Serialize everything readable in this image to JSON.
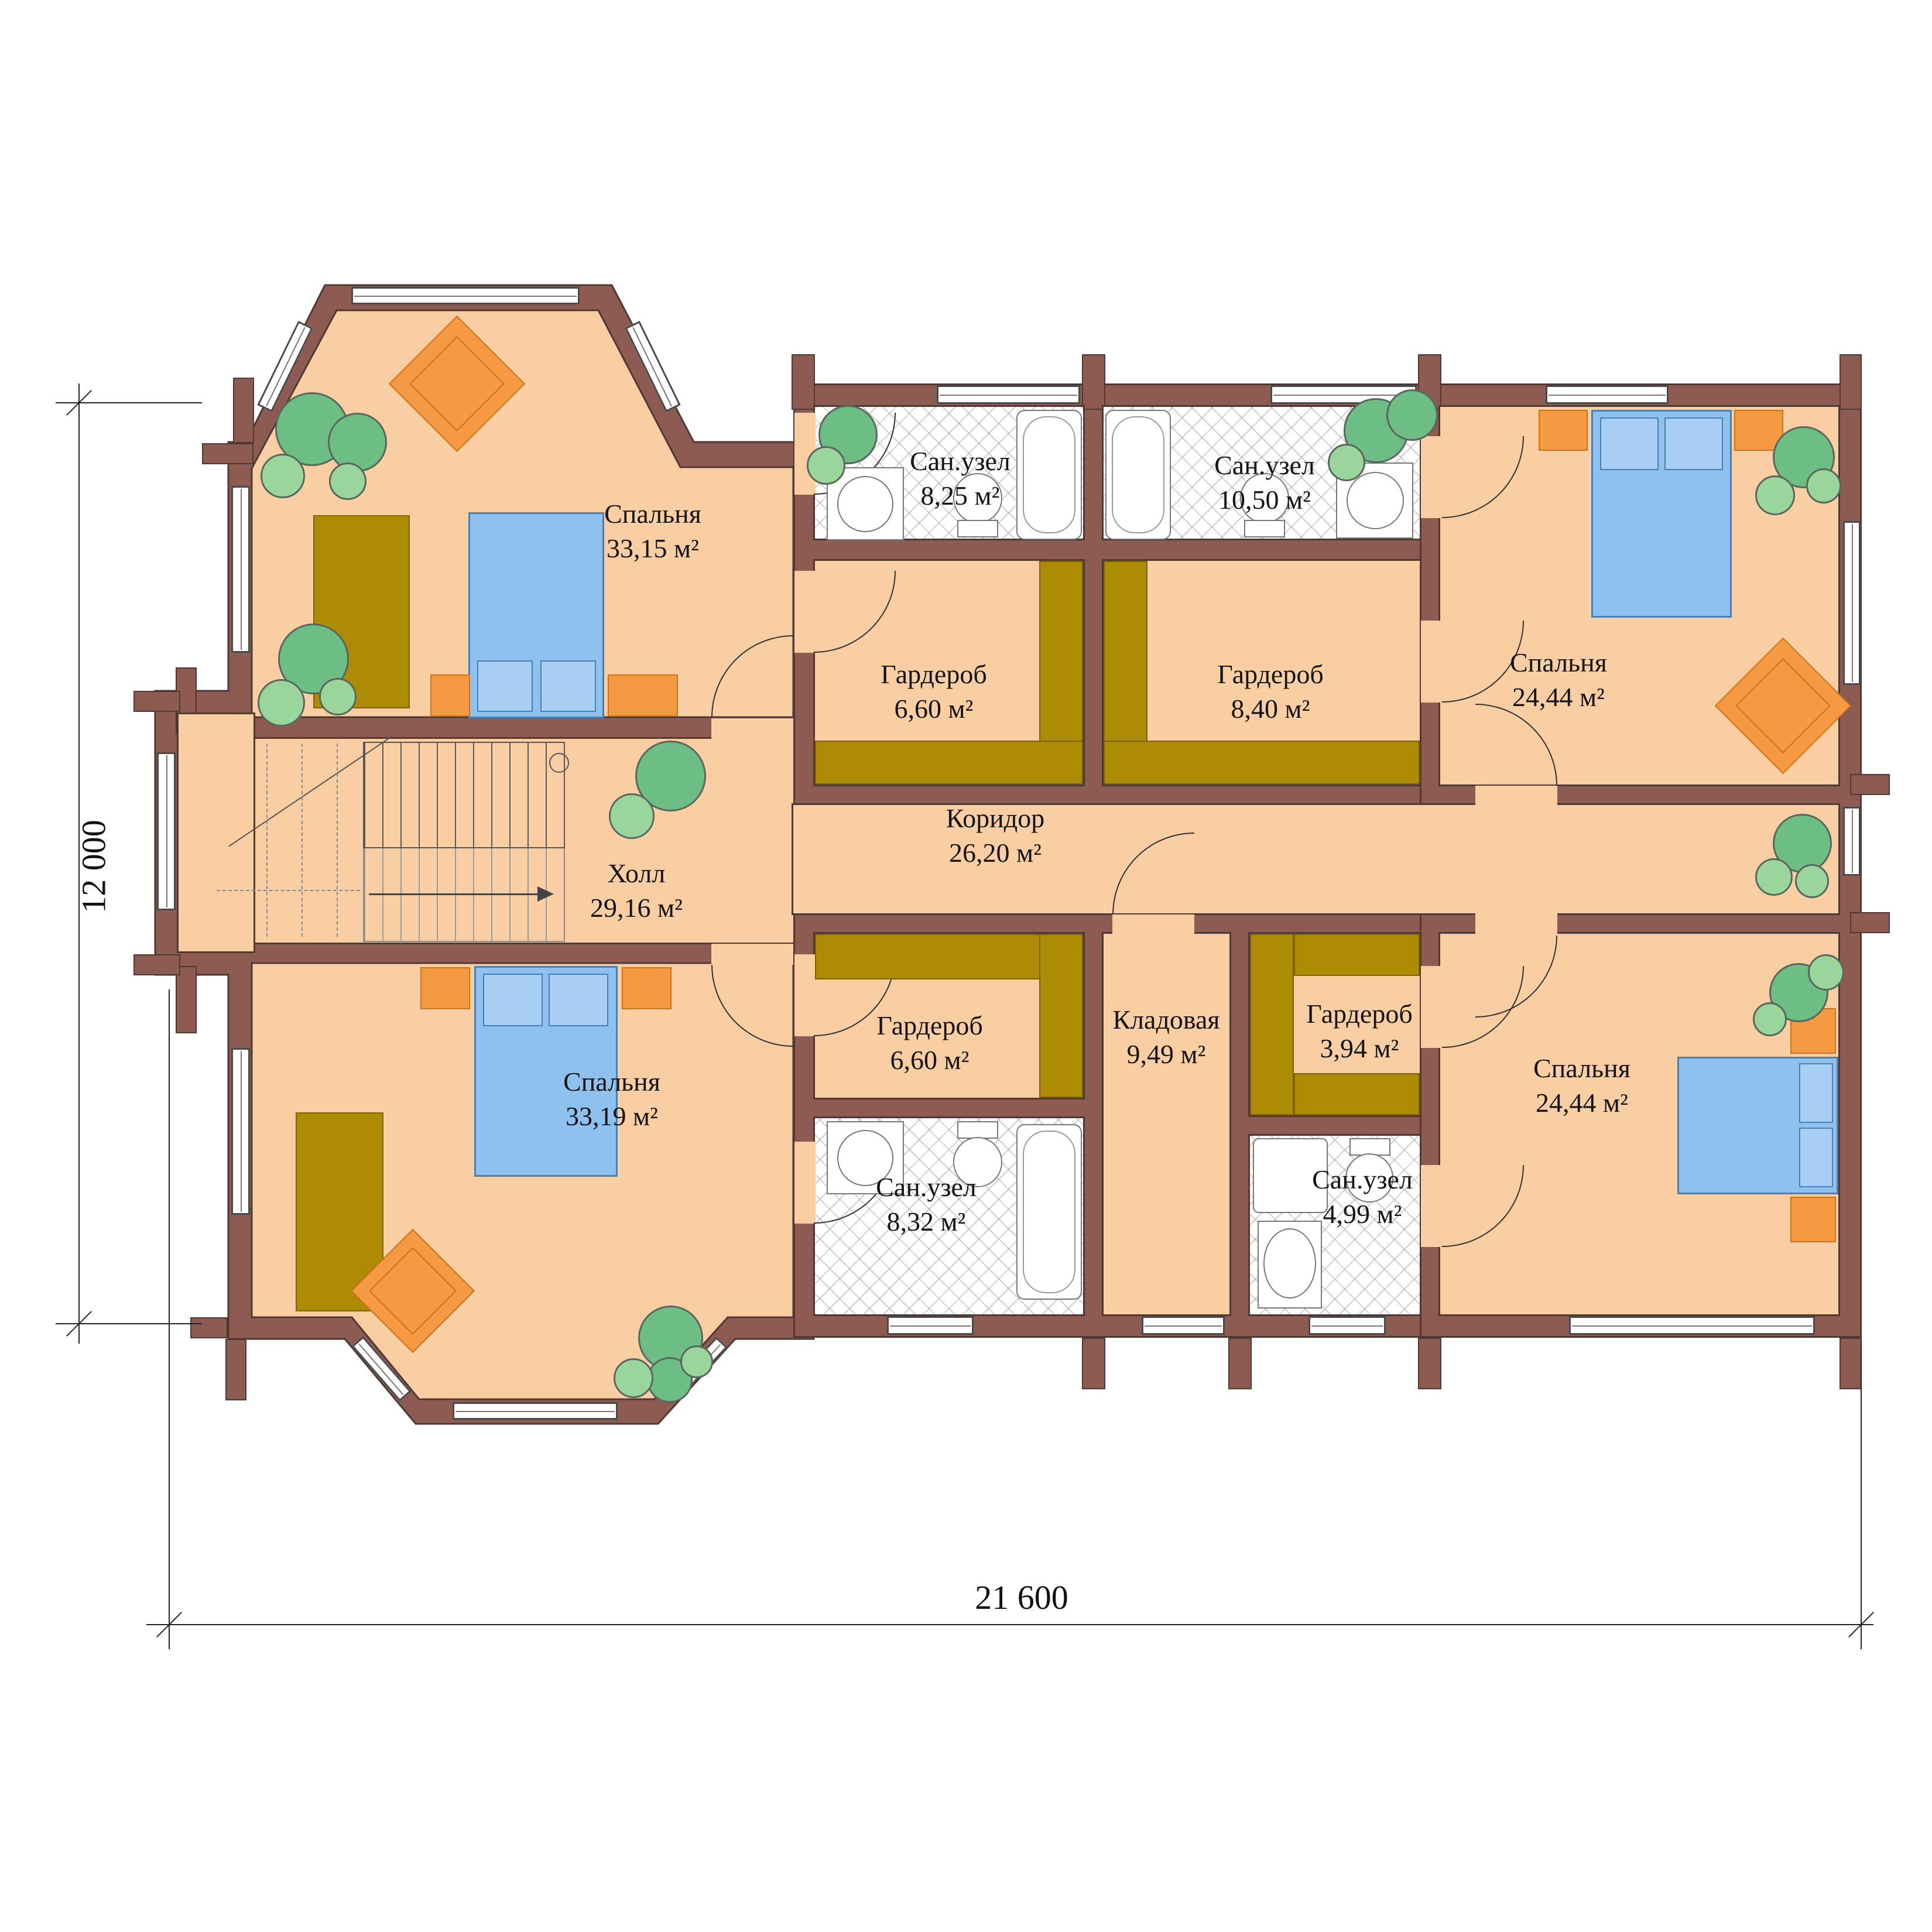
{
  "rooms": {
    "bedroom_top_left": {
      "name": "Спальня",
      "area": "33,15 м²"
    },
    "bath_top_left": {
      "name": "Сан.узел",
      "area": "8,25 м²"
    },
    "bath_top_right": {
      "name": "Сан.узел",
      "area": "10,50 м²"
    },
    "bedroom_top_right": {
      "name": "Спальня",
      "area": "24,44 м²"
    },
    "wardrobe_top_left": {
      "name": "Гардероб",
      "area": "6,60 м²"
    },
    "wardrobe_top_right": {
      "name": "Гардероб",
      "area": "8,40 м²"
    },
    "hall": {
      "name": "Холл",
      "area": "29,16 м²"
    },
    "corridor": {
      "name": "Коридор",
      "area": "26,20 м²"
    },
    "wardrobe_bottom_left": {
      "name": "Гардероб",
      "area": "6,60 м²"
    },
    "storage": {
      "name": "Кладовая",
      "area": "9,49 м²"
    },
    "wardrobe_bottom_right": {
      "name": "Гардероб",
      "area": "3,94 м²"
    },
    "bedroom_bottom_right": {
      "name": "Спальня",
      "area": "24,44 м²"
    },
    "bedroom_bottom_left": {
      "name": "Спальня",
      "area": "33,19 м²"
    },
    "bath_bottom_left": {
      "name": "Сан.узел",
      "area": "8,32 м²"
    },
    "bath_bottom_right": {
      "name": "Сан.узел",
      "area": "4,99 м²"
    }
  },
  "dimensions": {
    "overall_width": "21 600",
    "overall_height": "12 000"
  },
  "colors": {
    "floor": "#F9CEA2",
    "wall": "#8D5B52",
    "closet": "#AD8B05",
    "furniture_orange": "#F59A42",
    "bed_blue": "#8FC1EF",
    "plant_green": "#6CBE84",
    "tile": "#FFFFFF"
  }
}
